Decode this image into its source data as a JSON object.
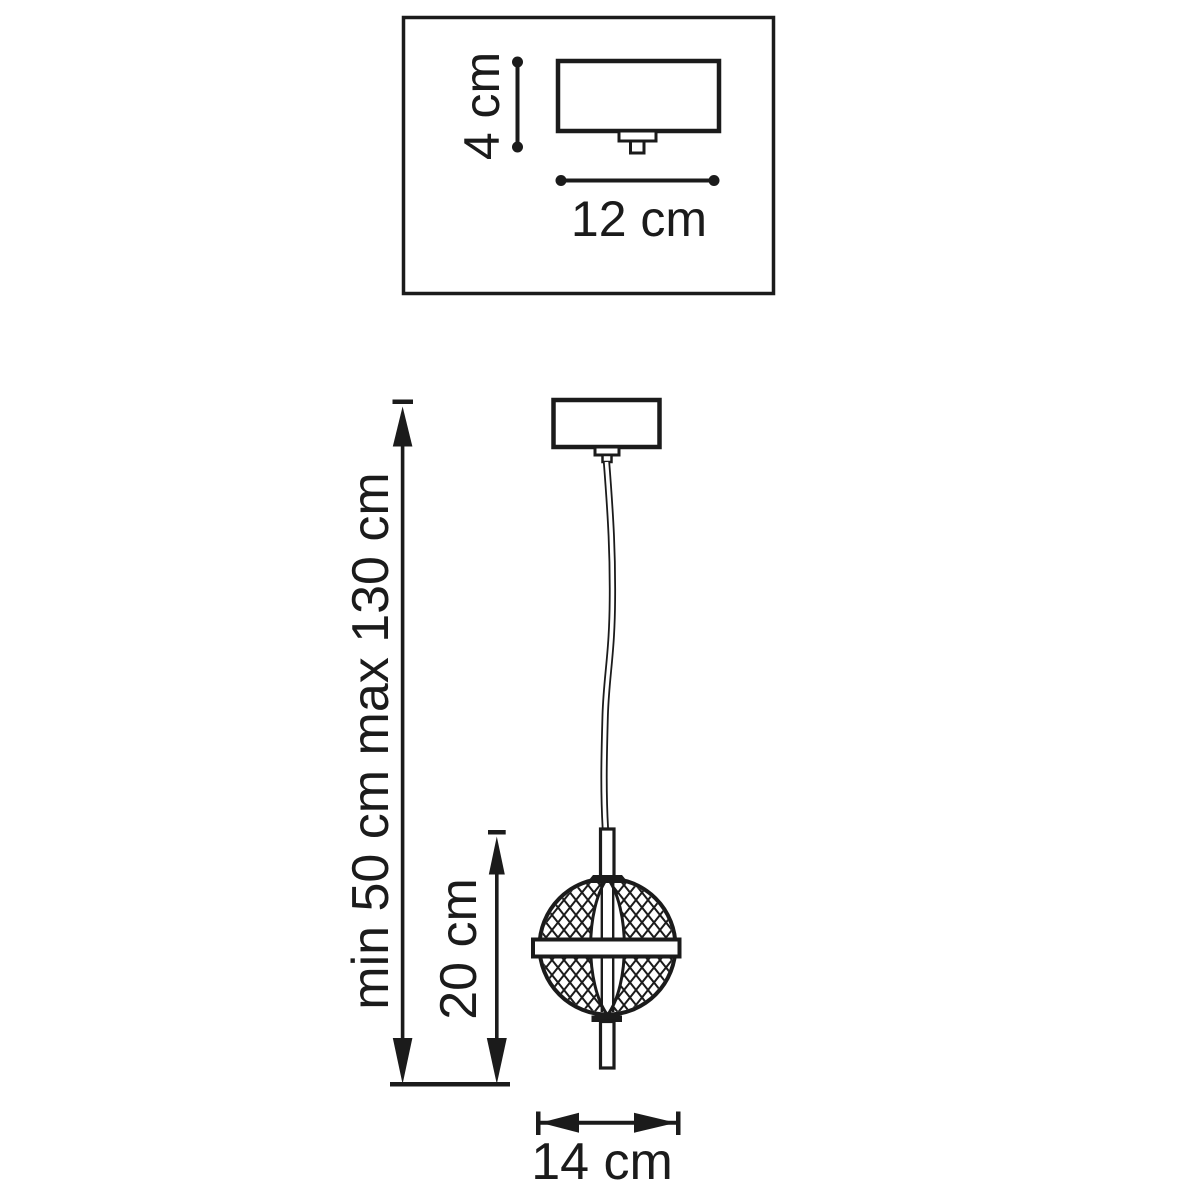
{
  "inset_diagram": {
    "height_dimension": "4 cm",
    "width_dimension": "12 cm"
  },
  "pendant_diagram": {
    "suspension_dimension": "min 50 cm max 130 cm",
    "fixture_height_dimension": "20 cm",
    "fixture_width_dimension": "14 cm"
  },
  "colors": {
    "ink": "#1b1b1b",
    "background": "#ffffff"
  }
}
